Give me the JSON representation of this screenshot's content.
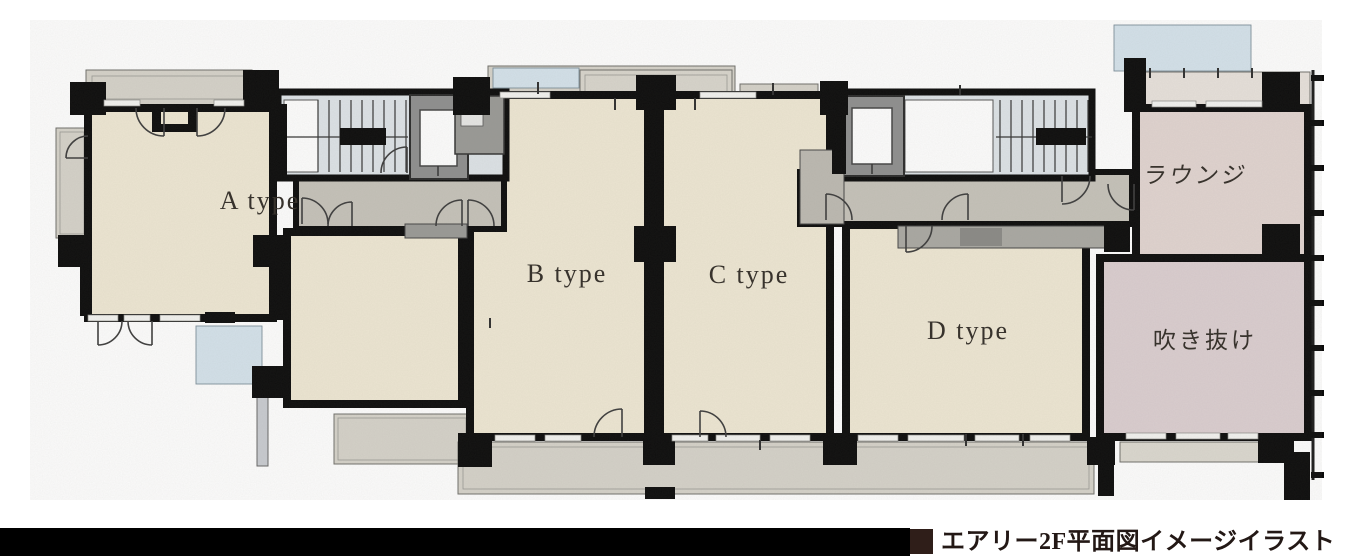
{
  "plan": {
    "rooms": {
      "a": {
        "label": "A type"
      },
      "b": {
        "label": "B type"
      },
      "c": {
        "label": "C type"
      },
      "d": {
        "label": "D type"
      },
      "lounge": {
        "label": "ラウンジ"
      },
      "void": {
        "label": "吹き抜け"
      }
    }
  },
  "caption": {
    "text": "エアリー2F平面図イメージイラスト"
  },
  "colors": {
    "floor_unit": "#efe8d4",
    "floor_lounge": "#e2d5d1",
    "floor_void": "#dccfd1",
    "corridor": "#c6c3ba",
    "balcony": "#d6d3ca",
    "stairwell": "#dee4e8",
    "water_blue": "#d5e3ec",
    "lounge_top_strip": "#e8e2dc",
    "wall": "#0a0a0a",
    "caption_marker": "#2f1e19",
    "footer_bar": "#000000"
  }
}
